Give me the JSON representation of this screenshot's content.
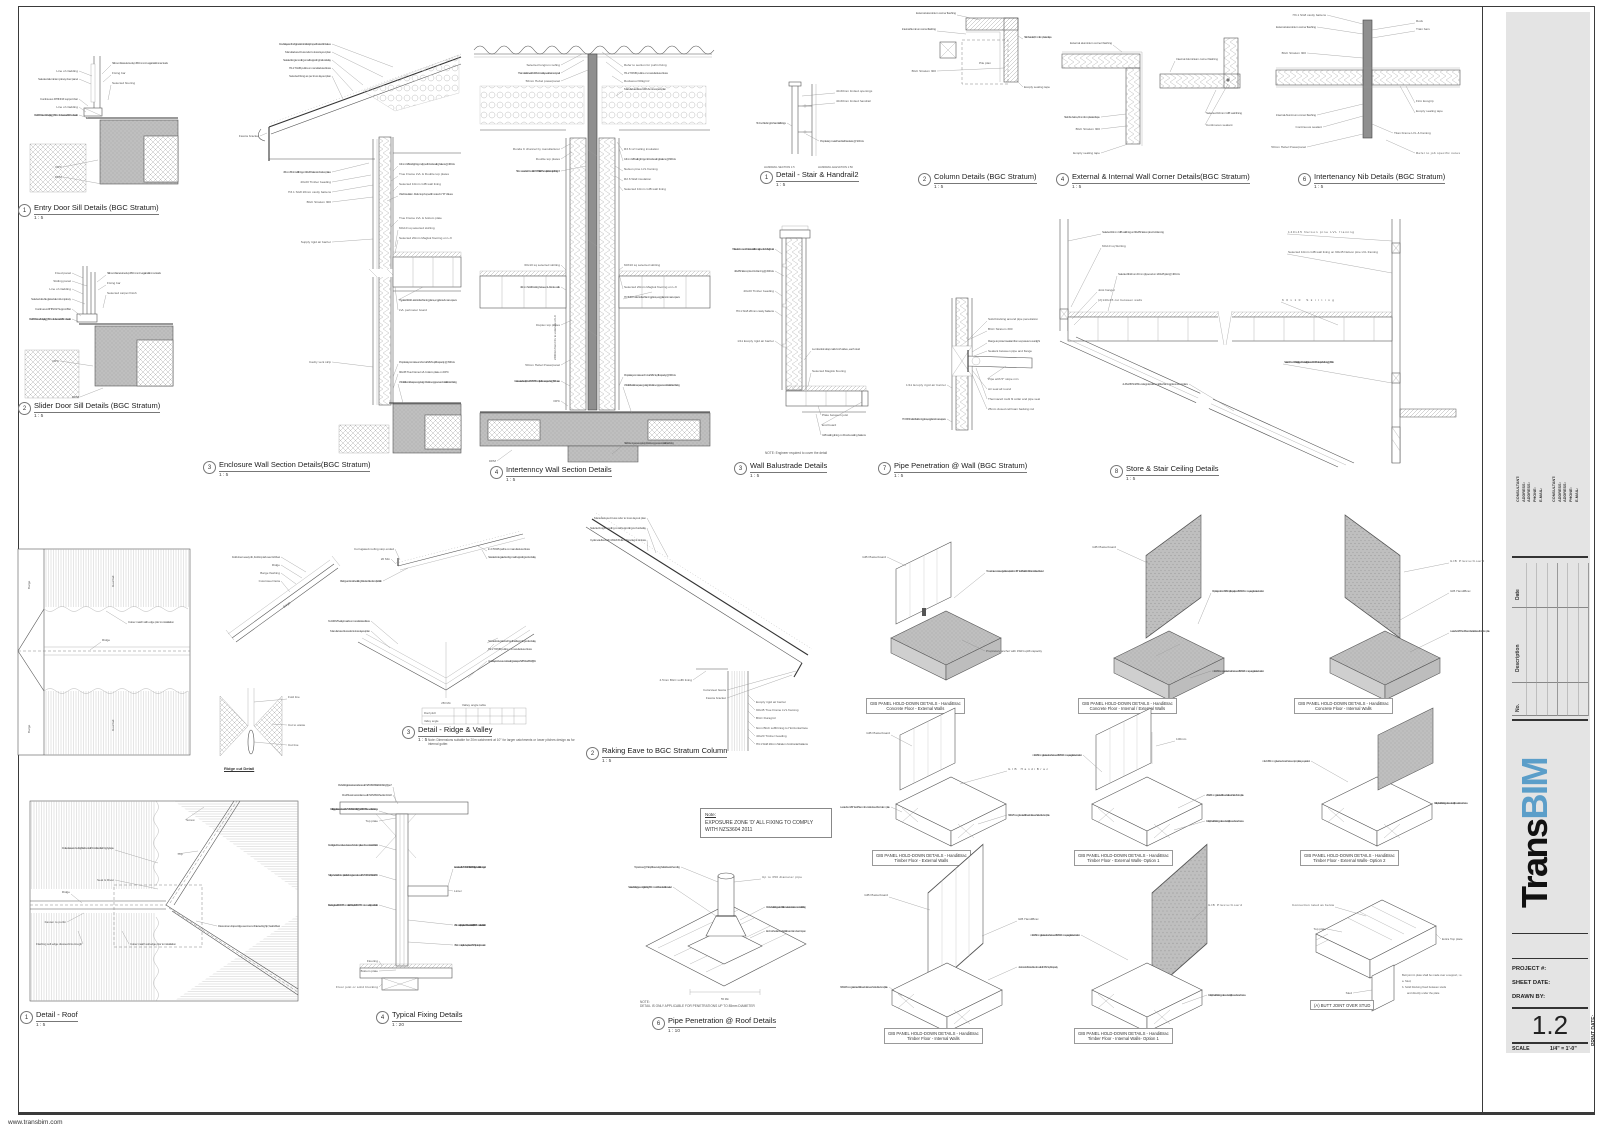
{
  "sheet": {
    "website": "www.transbim.com",
    "logo": {
      "black": "Trans",
      "blue": "BIM"
    },
    "titleblock": {
      "consultant_lines": [
        "CONSULTANT:",
        "ADDRESS:",
        "ADDRESS:",
        "PHONE:",
        "E-MAIL:"
      ],
      "rev_date": "Date",
      "rev_description": "Description",
      "rev_no": "No.",
      "project_label": "PROJECT #:",
      "sheet_date_label": "SHEET DATE:",
      "drawn_by_label": "DRAWN BY:",
      "sheet_number": "1.2",
      "scale_label": "SCALE",
      "scale_value": "1/4\" = 1'-0\"",
      "print_date_label": "PRINT DATE:"
    }
  },
  "details": [
    {
      "num": "1",
      "title": "Entry Door Sill Details (BGC Stratum)",
      "scale": "1 : 5"
    },
    {
      "num": "2",
      "title": "Slider Door Sill Details (BGC Stratum)",
      "scale": "1 : 5"
    },
    {
      "num": "3",
      "title": "Enclosure Wall Section Details(BGC Stratum)",
      "scale": "1 : 5"
    },
    {
      "num": "4",
      "title": "Intertenncy Wall Section Details",
      "scale": "1 : 5"
    },
    {
      "num": "1",
      "title": "Detail - Stair & Handrail2",
      "scale": "1 : 5"
    },
    {
      "num": "2",
      "title": "Column Details (BGC Stratum)",
      "scale": "1 : 5"
    },
    {
      "num": "4",
      "title": "External & Internal Wall Corner Details(BGC Stratum)",
      "scale": "1 : 5"
    },
    {
      "num": "6",
      "title": "Intertenancy Nib Details (BGC Stratum)",
      "scale": "1 : 5"
    },
    {
      "num": "3",
      "title": "Wall Balustrade Details",
      "scale": "1 : 5"
    },
    {
      "num": "7",
      "title": "Pipe Penetration @ Wall (BGC Stratum)",
      "scale": "1 : 5"
    },
    {
      "num": "8",
      "title": "Store & Stair Ceiling Details",
      "scale": "1 : 5"
    },
    {
      "num": "3",
      "title": "Detail - Ridge & Valley",
      "scale": "1 : 5"
    },
    {
      "num": "2",
      "title": "Raking Eave to BGC Stratum Column",
      "scale": "1 : 5"
    },
    {
      "num": "1",
      "title": "Detail - Roof",
      "scale": "1 : 5"
    },
    {
      "num": "4",
      "title": "Typical Fixing Details",
      "scale": "1 : 20"
    },
    {
      "num": "6",
      "title": "Pipe Penetration @ Roof Details",
      "scale": "1 : 10"
    }
  ],
  "ridgecut_caption": "Ridge cut Detail",
  "gib_labels": [
    {
      "l1": "GIB PANEL HOLD-DOWN DETAILS - HandiBrac",
      "l2": "Concrete Floor - External Walls"
    },
    {
      "l1": "GIB PANEL HOLD-DOWN DETAILS - HandiBrac",
      "l2": "Concrete Floor - Internal / External Walls"
    },
    {
      "l1": "GIB PANEL HOLD-DOWN DETAILS - HandiBrac",
      "l2": "Concrete Floor - Internal Walls"
    },
    {
      "l1": "GIB PANEL HOLD-DOWN DETAILS - HandiBrac",
      "l2": "Timber Floor - External Walls"
    },
    {
      "l1": "GIB PANEL HOLD-DOWN DETAILS - HandiBrac",
      "l2": "Timber Floor - External Walls- Option 1"
    },
    {
      "l1": "GIB PANEL HOLD-DOWN DETAILS - HandiBrac",
      "l2": "Timber Floor - External Walls- Option 2"
    },
    {
      "l1": "GIB PANEL HOLD-DOWN DETAILS - HandiBrac",
      "l2": "Timber Floor - Internal Walls"
    },
    {
      "l1": "GIB PANEL HOLD-DOWN DETAILS - HandiBrac",
      "l2": "Timber Floor - Internal Walls- Option 1"
    }
  ],
  "butt_joint_label": "(A) BUTT JOINT OVER STUD",
  "notes": {
    "exposure_heading": "Note:",
    "exposure_body": "EXPOSURE ZONE 'D' ALL FIXING TO COMPLY WITH NZS3604 2011",
    "balustrade": "NOTE: Engineer required to cover the detail",
    "pipe_note1": "NOTE:",
    "pipe_note2": "DETAIL IS ONLY APPLICABLE FOR PENETRATIONS UP TO 85mm DIAMETER",
    "valley_table_title": "Valley angle table",
    "valley_row1": "Roof pitch",
    "valley_row2": "Valley angle",
    "valley_note": "Note: Dimensions suitable for 20m catchment at 10° for larger catchments or lower pitches design as for internal gutter."
  },
  "ann": {
    "entry": [
      "Line of cladding",
      "Selected aluminium joinery door panel",
      "Continuous RHINOZ support bar",
      "Line of cladding",
      "8G x 40 SS Screws & Rawl plug @ 150mm from the corners & 450mm thereafter",
      "Sill membrane turned up 150mm min. against trimmer studs",
      "Fixing bar",
      "Selected flooring",
      "DPC",
      "DPM"
    ],
    "slider": [
      "Fixed panel",
      "Sliding panel",
      "Line of cladding",
      "Selected double glazed aluminium joinery",
      "Continuous RHINOZ Support Bar",
      "8G x 40 SS Screws & Rawl plug @ 150mm from the corners & 450mm thereafter",
      "Sill membrane turned up 150mm min. against trimmer studs",
      "Fixing bar",
      "Selected carpet finish",
      "DPC",
      "DPM"
    ],
    "encl_l": [
      "Double layers of Ceiling insulation. Refer to job specific notes for R values",
      "Manufactured truss refer to truss layout plan",
      "Selected longrun roofing on self supporting Cell underlay",
      "H1.2 70x45 purlins on manufactured truss",
      "Selected fixing as per truss layout plan",
      "Fascia bracket",
      "4.5mm BGC soffit lining on 90x45 battens to Nelson plates",
      "40x20 Timber beading",
      "H3.1 SG8 20mm cavity battens",
      "BGC Stratum 300",
      "Supply rigid air barrier",
      "Cavity vent strip"
    ],
    "encl_r": [
      "13mm GIB ceiling lining on clipped Ronda ceiling battens @ 400 crs",
      "True Frame LVL & Double top plates",
      "Selected 10mm GIB wall lining",
      "Wall insulation. Refer to job specific notes for \"R\" Values",
      "True Frame LVL & bottom plate",
      "60x10 sq selected skirting",
      "Selected 20mm Maglok flooring on LJI",
      "Hyjoist 240x90 - refer to floor framing plans, eng plans & manu specs",
      "LVL perimeter board",
      "Proprietary concrete anchor with 8kN uplift capacity @ 600 crs",
      "90x45 True Frame LVL bottom plate on DPC",
      "Whaffle floor slab as per eng design. Refer to eng specs and details for reinforcing"
    ],
    "itl": [
      "Selected longrun roofing",
      "Thermakraft coverlab 407 roof underlay over intertenancy wall",
      "50mm Hebel powerpanel",
      "Ronda C channel by manufacturer",
      "Double top plates",
      "50mm non asbs x 13mm thick OSB Stratified. Thermal strip with density of 110kg/m³",
      "60x10 sq selected skirting",
      "40mm Solid blocking between LJIs to tie walls",
      "Duplex top plates",
      "50mm Hebel Powerpanel",
      "Continuous steel channel (Ronda 75x35x0.55mm) fixed with masonry anchors @ 600 max crs",
      "2400mm from FFL to underside of LJI",
      "DPC",
      "DPM"
    ],
    "itr": [
      "Refer to section for purlin fixing",
      "H1.2 70X45 purlins on manufactured truss",
      "Rockwool 60kg/m³",
      "Manufactured truss GRK & manu specs plan",
      "R3.6 x2 Ceiling insulation",
      "13mm GIB ceiling lining on Ronda ceiling battens @ 600 crs",
      "Nelson pine LVL framing",
      "R2.6 Wall insulation",
      "Selected 10mm GIB wall lining",
      "60X10 sq selected skirting",
      "Selected 20mm Maglok flooring on LJI",
      "HYJOIST - refer to floor framing plans, eng plans & manu specs",
      "Proprietary concrete anchor with 8kN uplift capacity @ 600 crs",
      "Whaffle floor slab as per eng design. Refer to eng specs and details for reinforcing",
      "Slab thickening as per eng design. Refer to eng specs and details for reinforcing"
    ],
    "stair": [
      "40-60mm limited openings",
      "40-60mm limited handrail",
      "Timber blocking for handrail fixings",
      "Proprietary metal handrail brackets @ 900 crs",
      "HANDRAIL SECTION 1:5",
      "HANDRAIL ELEVATION 1:50"
    ],
    "column": [
      "External aluminium corner flashing",
      "Internal Aluminum corner flashing",
      "BGC Stratum 300",
      "Stab the twists, 8mm from plasterd tape",
      "Ecoply sealing tape",
      "Pile plan"
    ],
    "corner": [
      "External aluminium corner flashing",
      "Stab the below, 8mm from plasterd tape",
      "BGC Stratum 300",
      "Ecoply sealing tape",
      "Internal Aluminium corner flashing",
      "Selected 10mm GIB wall lining",
      "Continuous sealant"
    ],
    "nib": [
      "H3.1 SG8 cavity battens",
      "External aluminium corner flashing",
      "BGC Stratum 300",
      "Internal Aluminum corner flashing",
      "Continuous sealant",
      "Rock",
      "Train bars",
      "Firm Ecogrip",
      "Ecoply sealing tape",
      "Titan Frame LVL & framing",
      "50mm Hebel Powerpanel",
      "Refer to job specific notes"
    ],
    "bal": [
      "Half-steel cut down end of balustrade at first floor wall ground floor half height walls",
      "40x45 Nelson pine LVL framing @ 400 crs",
      "40x20 Timber beading",
      "H3.1 SG8 20mm cavity battens",
      "1/11 Ecoply rigid air barrier",
      "Lumberlok strap nails both sides, each stud",
      "Selected Maglok flooring",
      "Plate between joist",
      "End board",
      "GIB ceiling lining on Ronda ceiling battens"
    ],
    "pw": [
      "Solid blocking around pipe penetration",
      "BGC Stratum 300",
      "Flange to protect sealant from exposure to sunlight",
      "Sealant between pipe and flange",
      "Pipe with 5° slope min",
      "Air seal all round",
      "Thermacell multi fit collar and pipe seal",
      "25mm closed cell foam backing rod",
      "1/11 Ecoply rigid air barrier",
      "HYJOIST - refer to floor framing plans, eng plans & manu specs"
    ],
    "st": [
      "Selected 10mm GIB wall lining on 90x45 Nelson pine LVL framing",
      "60x10 sq Skirting",
      "Selected finish on 20mm plywood on 140x45 joist @ 400 crs",
      "Joist hanger",
      "(2)140x45 cut between walls",
      "140x45 Nelson pine LVL framing",
      "Selected 10mm GIB wall lining on 90x45 Nelson pine LVL framing",
      "60x10 Skirting",
      "Selected 10mm GIB raking lining on Ronda ceiling battens on 140x45 Nelson pine LVL framing @ 400 crs",
      "JL 45x245 SG8 Boundary joist, refer to midfloor framing plan and eng plans"
    ],
    "rp": [
      "Barge",
      "Roof fall",
      "Ridge",
      "Colour match with edge prior to installation",
      "Barge",
      "Roof fall"
    ],
    "bg": [
      "Fold down every rib, Fold top tab over & Rivet",
      "Ridge",
      "Barge flashing",
      "Colorsteel facia",
      "Barge"
    ],
    "rc": [
      "Fold line",
      "Cut to waste",
      "Cut line"
    ],
    "rv": [
      "Corrugated roofing stop ended",
      "20 Min",
      "Plashguard or notched trailing folded and fixed to roof profile rib",
      "In 2 70X45 purlins on manufactured truss",
      "Selected corrugated roofing on self supporting roof underlay",
      "6 x 100X25 valley boards on manufactured truss",
      "Manufactured truss refer to truss layout plan",
      "250 Min",
      "Selected corrugated roofing with self supporting roof underlay",
      "H1.2 70X45 purlins on manufactured truss",
      "Underlay continuous underneath gutter as per NZBC E2/AS1 fig. 51"
    ],
    "re": [
      "Manufactured truss refer to truss layout plan",
      "Selected longrun roofing on self supporting roof underlay",
      "Cyclone tie fixed with 4 30x3.15 dia. nails per leg & 1 in truss",
      "Colorsteel fascia",
      "Fascia bracket",
      "4.5mm BGC soffit lining",
      "Ecoply rigid air barrier",
      "90x45 True Frame LVL framing",
      "BGC Duragrid",
      "6mm BGC soffit lining to Horizontal face",
      "40x20 Timber beading",
      "H3.1 SG8 20mm Stratum horizontal battens"
    ],
    "rf": [
      "Screw",
      "Hip",
      "Dotted area to be fully flashed with hotdries flashing by tape",
      "Seal & Rivet",
      "Ridge",
      "Fasten to purlin",
      "Flashing soft edge dressed into trough",
      "Colour match soft edge prior to installation",
      "Dress crown of apex ridge over crown of intersecting hip, Seal & Rivet"
    ],
    "fx": [
      "Purlins Fixing to truss in accordance with NZS3604 Table 5.10 Fixing Type 7",
      "Roof Truss in accordance with NZS3604 Section 10.2.2",
      "Rafter fixing to top plates in accordance with NZS3604 Table 10.14 Fixing Type B - 2/90x3.15 skewed nails + 2 wire dogs",
      "Top plate",
      "Doubling stud to be continuous between the bottom plate and the underside of the lintel",
      "Nailing schedules for bottom plate to floor framing in accordance with NZS3604:2011 table 8.19",
      "Fix studs together with 100x3.75mm nails at 800 crs, with 2/100x3.75mm immediately under the lintel",
      "Flooring",
      "Bottom plate",
      "Floor joist or solid blocking",
      "Lintel",
      "In accordance with NZS3604:2011 table 8.18 Nailing schedules for lintel to trimming stud",
      "25x1mm strap fixed over plate and 100 on each side of stud, with 6/30x2.5mm nails into each side of stud",
      "35x1mm strap fixed over plate or a 7.5kN (tension) connection"
    ],
    "pr": [
      "Top screws @ Will uphills securing the flat sheet to the roofing",
      "Selected flashing tape on ridge flashing 150mm min. Riveted and silicon sealed",
      "Up to 350 diameter pipe",
      "Rubber boot flashing sealed with silicon sealant and set screws onto roof flashing",
      "End notched around profile ribs and turn down into pan",
      "55 Min"
    ],
    "g": [
      "GIB Plasterboard",
      "GIB HandiBrac",
      "To maximise concrete edge distance, locate the GIB HandiBrac flush with the inside face of the stud",
      "Proprietary anchor with 15kN uplift capacity",
      "Proprietary anchor with 15kN uplift capacity and 50x50x3mm square galvanised washer",
      "400x25x1.0mm galvanised strap (strap passes underneath bottom plate)",
      "Locate the GIB HandiBrac on the inside face of the bottom plate",
      "6 / 30x2.5mm galvanised flat head nails to each side of stud and plate",
      "m12 x 150mm galvanised coach screw and 50x50x3mm square galvanised washer",
      "2 / 30x2.5mm galvanised flat head nails in each side of bottom plate",
      "m12 x 150mm galvanised coach screw or proprietary equivalent",
      "Full depth solid blocking positioned centrally beneath coach screw",
      "Jack stud or first stud fixed to wall with 15kN uplift capacity",
      "100mm",
      "Stud"
    ],
    "bt": [
      "Connection rated as below",
      "Top plate",
      "Extra Top plate",
      "Stud",
      "Butt joint in plate shall be made over a support, i.e.",
      "a.  Stud,",
      "b.  Solid blocking fixed between studs",
      "and directly under the plate"
    ]
  }
}
